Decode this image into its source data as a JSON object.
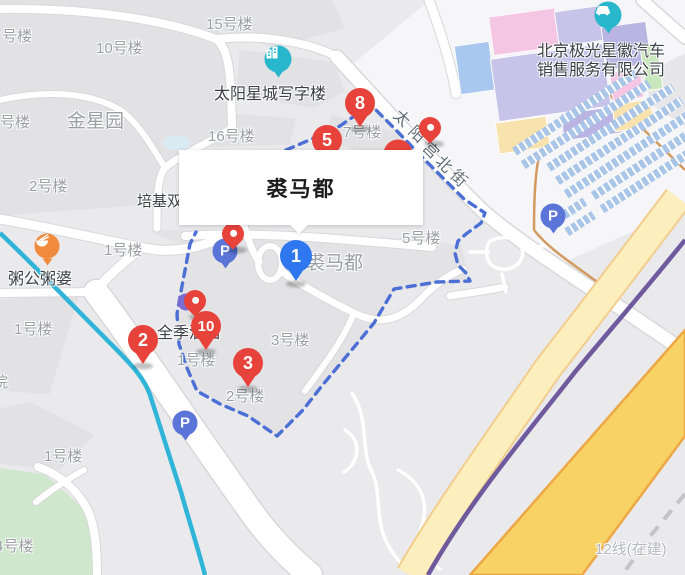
{
  "map": {
    "infobox": {
      "title": "裘马都"
    },
    "street": {
      "name": "太阳宫北街",
      "chars": [
        {
          "t": "太",
          "x": 395,
          "y": 105
        },
        {
          "t": "阳",
          "x": 410,
          "y": 121
        },
        {
          "t": "宫",
          "x": 424,
          "y": 137
        },
        {
          "t": "北",
          "x": 437,
          "y": 151
        },
        {
          "t": "街",
          "x": 452,
          "y": 165
        }
      ]
    },
    "labels": [
      {
        "t": "号楼",
        "x": 2,
        "y": 25,
        "c": "b"
      },
      {
        "t": "10号楼",
        "x": 96,
        "y": 37,
        "c": "b"
      },
      {
        "t": "15号楼",
        "x": 206,
        "y": 13,
        "c": "b"
      },
      {
        "t": "号楼",
        "x": 0,
        "y": 111,
        "c": "b"
      },
      {
        "t": "金星园",
        "x": 67,
        "y": 106,
        "c": "bg"
      },
      {
        "t": "2号楼",
        "x": 29,
        "y": 175,
        "c": "b"
      },
      {
        "t": "16号楼",
        "x": 208,
        "y": 125,
        "c": "b"
      },
      {
        "t": "7号楼",
        "x": 343,
        "y": 121,
        "c": "b"
      },
      {
        "t": "1号楼",
        "x": 104,
        "y": 239,
        "c": "b"
      },
      {
        "t": "培基双",
        "x": 137,
        "y": 190,
        "c": "poi"
      },
      {
        "t": "5号楼",
        "x": 402,
        "y": 227,
        "c": "b"
      },
      {
        "t": "裘马都",
        "x": 306,
        "y": 248,
        "c": "bg"
      },
      {
        "t": "3号楼",
        "x": 271,
        "y": 329,
        "c": "b"
      },
      {
        "t": "1号楼",
        "x": 14,
        "y": 318,
        "c": "b"
      },
      {
        "t": "1号楼",
        "x": 177,
        "y": 349,
        "c": "b"
      },
      {
        "t": "2号楼",
        "x": 226,
        "y": 385,
        "c": "b"
      },
      {
        "t": "院",
        "x": -7,
        "y": 371,
        "c": "b"
      },
      {
        "t": "1号楼",
        "x": 44,
        "y": 445,
        "c": "b"
      },
      {
        "t": "4号楼",
        "x": -5,
        "y": 535,
        "c": "b"
      },
      {
        "t": "12线(在建)",
        "x": 595,
        "y": 538,
        "c": "mut"
      },
      {
        "t": "全季酒店",
        "x": 157,
        "y": 319,
        "c": "poiL"
      },
      {
        "t": "太阳星城写字楼",
        "x": 214,
        "y": 80,
        "c": "poiL"
      },
      {
        "t": "粥公粥婆",
        "x": 8,
        "y": 265,
        "c": "poiL"
      },
      {
        "t": "北京极光星徽汽车",
        "x": 537,
        "y": 37,
        "c": "poiL"
      },
      {
        "t": "销售服务有限公司",
        "x": 537,
        "y": 56,
        "c": "poiL"
      }
    ],
    "markers": {
      "red_numbered": [
        {
          "n": "8",
          "x": 360,
          "y": 103
        },
        {
          "n": "5",
          "x": 327,
          "y": 140
        },
        {
          "n": "2",
          "x": 143,
          "y": 340
        },
        {
          "n": "10",
          "x": 206,
          "y": 326
        },
        {
          "n": "3",
          "x": 248,
          "y": 363
        }
      ],
      "blue_numbered": [
        {
          "n": "1",
          "x": 296,
          "y": 256
        }
      ],
      "red_pins": [
        {
          "x": 430,
          "y": 128
        },
        {
          "x": 233,
          "y": 234
        },
        {
          "x": 195,
          "y": 301
        }
      ],
      "hidden_marker": {
        "x": 398,
        "y": 154
      },
      "hidden_poi_dot": {
        "x": 186,
        "y": 302
      }
    },
    "parking_icons": {
      "letter": "P",
      "items": [
        {
          "x": 225,
          "y": 251
        },
        {
          "x": 185,
          "y": 423
        },
        {
          "x": 553,
          "y": 216
        }
      ]
    },
    "poi_icons": [
      {
        "icon": "office-building-icon",
        "x": 278,
        "y": 59,
        "kind": "teal"
      },
      {
        "icon": "car-dealer-icon",
        "x": 608,
        "y": 15,
        "kind": "teal"
      },
      {
        "icon": "restaurant-icon",
        "x": 47,
        "y": 246,
        "kind": "orange"
      }
    ],
    "colors": {
      "marker_red": "#e8433a",
      "marker_blue": "#2e77ee",
      "parking_blue": "#5b74d8",
      "poi_teal": "#29b7cd",
      "poi_orange": "#f08a3c",
      "boundary_blue": "#4c6fd6",
      "river_cyan": "#30b4d8",
      "road_yellow_major": "#f8d264",
      "road_yellow_minor": "#fdeebd",
      "metro_purple": "#6f5a9e"
    }
  }
}
